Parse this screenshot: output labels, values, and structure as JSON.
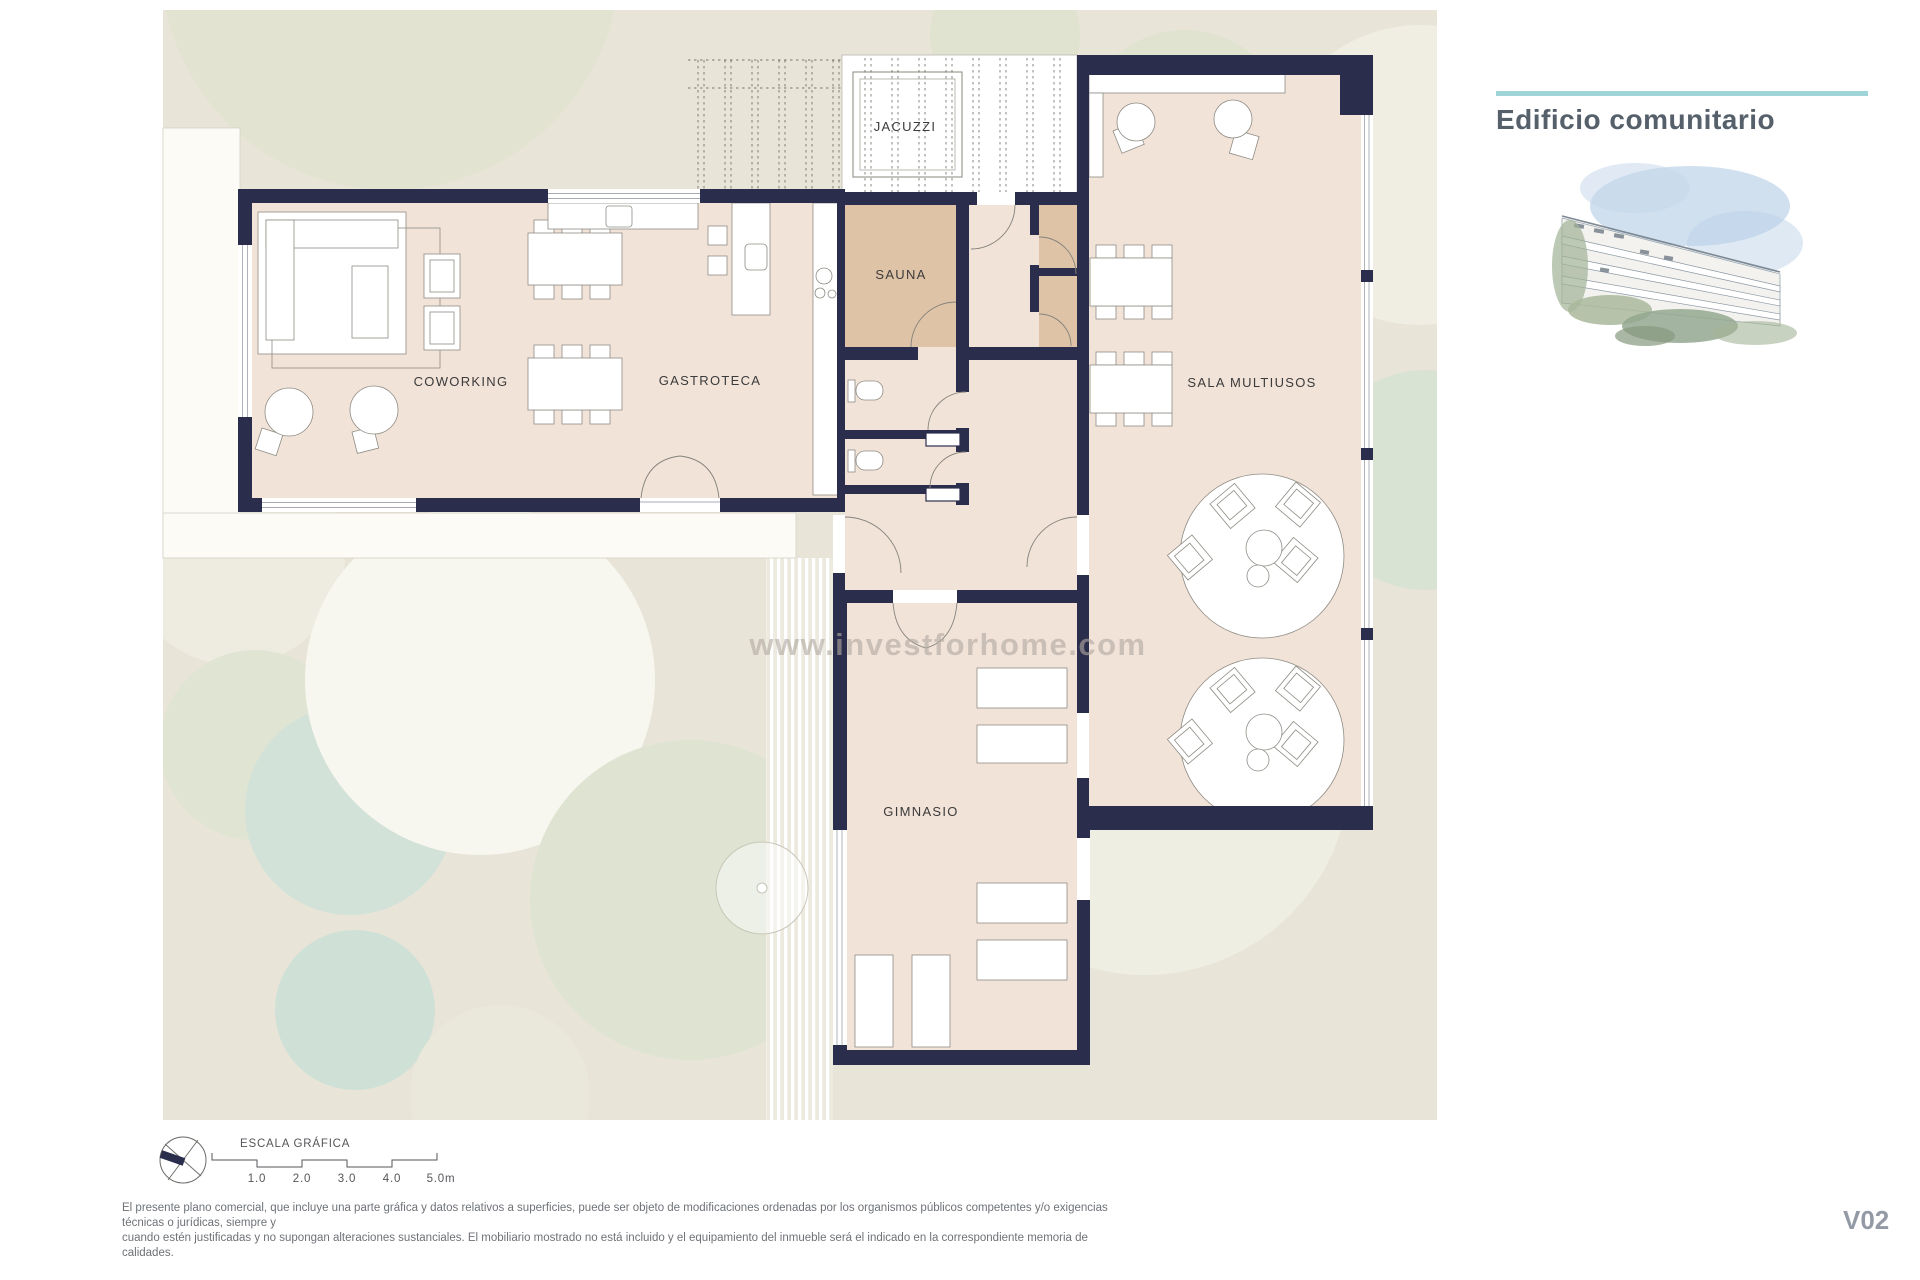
{
  "header": {
    "title": "Edificio comunitario"
  },
  "rooms": {
    "jacuzzi": "JACUZZI",
    "sauna": "SAUNA",
    "coworking": "COWORKING",
    "gastroteca": "GASTROTECA",
    "sala_multiusos": "SALA MULTIUSOS",
    "gimnasio": "GIMNASIO"
  },
  "watermark": "www.investforhome.com",
  "scale": {
    "label": "ESCALA GRÁFICA",
    "ticks": [
      "1.0",
      "2.0",
      "3.0",
      "4.0",
      "5.0m"
    ]
  },
  "disclaimer": {
    "line1": "El presente plano comercial, que incluye una parte gráfica y datos relativos a superficies, puede ser objeto de modificaciones ordenadas por los organismos públicos competentes y/o exigencias técnicas o jurídicas, siempre y",
    "line2": "cuando estén justificadas y no supongan alteraciones sustanciales. El mobiliario mostrado no está incluido y el equipamiento del inmueble será el indicado en la correspondiente memoria de calidades."
  },
  "version": "V02",
  "colors": {
    "wall": "#2b2d4c",
    "floor": "#f2e3d9",
    "sauna_floor": "#dfc3a7",
    "garden": "#e8e5d8",
    "accent_line": "#9fd4d8",
    "title_text": "#55606b"
  }
}
